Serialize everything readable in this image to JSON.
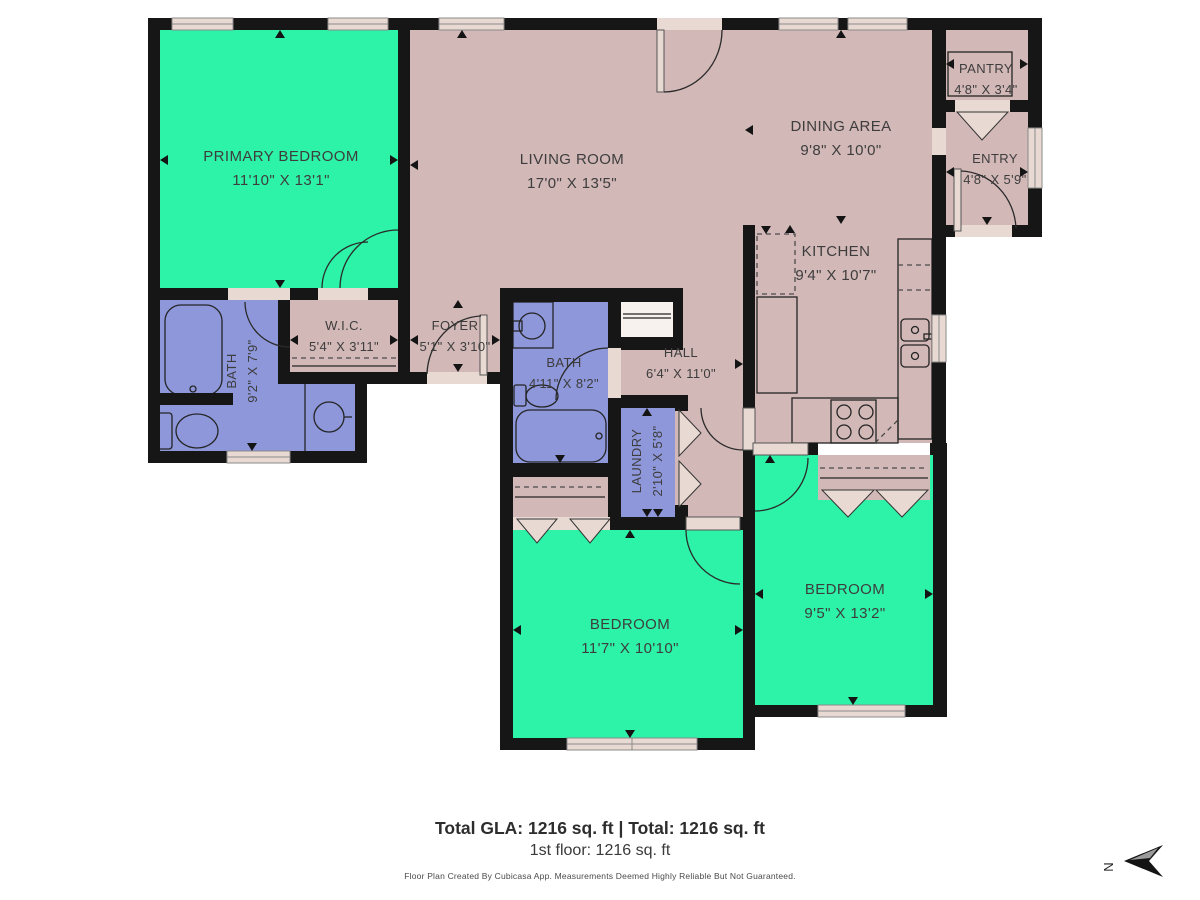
{
  "rooms": {
    "primary_bedroom": {
      "name": "PRIMARY BEDROOM",
      "dims": "11'10\" X 13'1\""
    },
    "living_room": {
      "name": "LIVING ROOM",
      "dims": "17'0\" X 13'5\""
    },
    "dining_area": {
      "name": "DINING AREA",
      "dims": "9'8\" X 10'0\""
    },
    "kitchen": {
      "name": "KITCHEN",
      "dims": "9'4\" X 10'7\""
    },
    "pantry": {
      "name": "PANTRY",
      "dims": "4'8\" X 3'4\""
    },
    "entry": {
      "name": "ENTRY",
      "dims": "4'8\" X 5'9\""
    },
    "wic": {
      "name": "W.I.C.",
      "dims": "5'4\" X 3'11\""
    },
    "foyer": {
      "name": "FOYER",
      "dims": "5'1\" X 3'10\""
    },
    "bath_primary": {
      "name": "BATH",
      "dims": "9'2\" X 7'9\""
    },
    "bath_2": {
      "name": "BATH",
      "dims": "4'11\" X 8'2\""
    },
    "hall": {
      "name": "HALL",
      "dims": "6'4\" X 11'0\""
    },
    "laundry": {
      "name": "LAUNDRY",
      "dims": "2'10\" X 5'8\""
    },
    "bedroom_center": {
      "name": "BEDROOM",
      "dims": "11'7\" X 10'10\""
    },
    "bedroom_right": {
      "name": "BEDROOM",
      "dims": "9'5\" X 13'2\""
    }
  },
  "footer": {
    "total": "Total GLA: 1216 sq. ft | Total: 1216 sq. ft",
    "floor": "1st floor: 1216 sq. ft",
    "disclaimer": "Floor Plan Created By Cubicasa App. Measurements Deemed Highly Reliable But Not Guaranteed."
  },
  "compass": {
    "letter": "N"
  },
  "colors": {
    "teal": "#2DF3A9",
    "mauve": "#D2B8B7",
    "blue": "#8D97DA",
    "wall": "#161616",
    "casing": "#E8D9D2",
    "closet_white": "#F7F2EE"
  }
}
